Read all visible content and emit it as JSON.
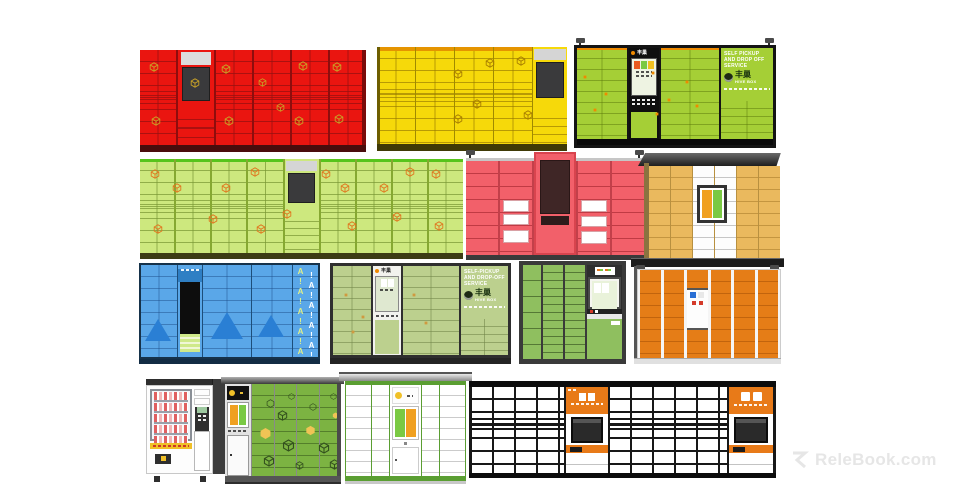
{
  "watermark": {
    "brand": "ReleBook.com"
  },
  "brands": {
    "hivebox_cn": "丰巢",
    "hivebox_en": "HIVE BOX"
  },
  "green_hivebox": {
    "console_logo": "丰巢",
    "panel_text": "SELF PICKUP AND DROP OFF SERVICE"
  },
  "sage_hivebox": {
    "console_logo": "丰巢",
    "panel_text": "SELF-PICKUP AND DROP-OFF SERVICE"
  },
  "blue_locker": {
    "pattern": "A!A!A!A!A!",
    "pattern2": "!A!A!A!A!"
  },
  "scene": {
    "background": "#ffffff",
    "units": [
      {
        "key": "red",
        "label": "Red smart parcel locker, 6 columns",
        "color": "#ea1510"
      },
      {
        "key": "yellow",
        "label": "Yellow smart parcel locker, 5 columns",
        "color": "#f6d90a"
      },
      {
        "key": "green-hivebox",
        "label": "Hive Box green parcel locker with console and cameras",
        "color": "#a5cf36"
      },
      {
        "key": "light-green",
        "label": "Light green parcel locker, 9 columns",
        "color": "#cde87e"
      },
      {
        "key": "pink",
        "label": "Pink parcel locker with raised center console and corner cameras",
        "color": "#f2606a"
      },
      {
        "key": "tan",
        "label": "Tan parcel locker with dark canopy",
        "color": "#eab95e"
      },
      {
        "key": "blue",
        "label": "Blue parcel locker with triangle logo pattern",
        "color": "#5aa7e8"
      },
      {
        "key": "sage-hivebox",
        "label": "Hive Box sage green parcel locker",
        "color": "#bcd08e"
      },
      {
        "key": "small-green",
        "label": "Compact green parcel locker with side console",
        "color": "#8fbf5f"
      },
      {
        "key": "orange",
        "label": "Orange parcel locker with canopy cameras",
        "color": "#e57d17"
      },
      {
        "key": "vending",
        "label": "Snack vending machine",
        "color": "#3a3a3a"
      },
      {
        "key": "dark-green",
        "label": "Green parcel locker with left console column",
        "color": "#7cb342"
      },
      {
        "key": "white-green",
        "label": "White and green parcel locker with center console",
        "color": "#5a9e32"
      },
      {
        "key": "long-white",
        "label": "Long white mailbox locker wall with two orange consoles",
        "color": "#ffffff"
      }
    ]
  },
  "icon_scatter": {
    "red": [
      {
        "x": 4,
        "y": 13
      },
      {
        "x": 36,
        "y": 15
      },
      {
        "x": 22,
        "y": 29
      },
      {
        "x": 52,
        "y": 29,
        "s": 9
      },
      {
        "x": 70,
        "y": 12
      },
      {
        "x": 85,
        "y": 13
      },
      {
        "x": 60,
        "y": 56,
        "s": 9
      },
      {
        "x": 5,
        "y": 69
      },
      {
        "x": 37,
        "y": 69
      },
      {
        "x": 68,
        "y": 69
      },
      {
        "x": 86,
        "y": 67
      }
    ],
    "yellow": [
      {
        "x": 57,
        "y": 11
      },
      {
        "x": 73,
        "y": 9
      },
      {
        "x": 40,
        "y": 23
      },
      {
        "x": 50,
        "y": 54
      },
      {
        "x": 40,
        "y": 69
      },
      {
        "x": 77,
        "y": 65
      }
    ],
    "lgreen": [
      {
        "x": 3,
        "y": 11
      },
      {
        "x": 10,
        "y": 25
      },
      {
        "x": 25,
        "y": 25
      },
      {
        "x": 21,
        "y": 58
      },
      {
        "x": 4,
        "y": 69
      },
      {
        "x": 34,
        "y": 9
      },
      {
        "x": 44,
        "y": 53
      },
      {
        "x": 36,
        "y": 69
      },
      {
        "x": 56,
        "y": 11
      },
      {
        "x": 62,
        "y": 25
      },
      {
        "x": 64,
        "y": 66
      },
      {
        "x": 74,
        "y": 25
      },
      {
        "x": 82,
        "y": 9
      },
      {
        "x": 90,
        "y": 11
      },
      {
        "x": 91,
        "y": 66
      },
      {
        "x": 78,
        "y": 56
      }
    ],
    "ghive": [
      {
        "x": 3,
        "y": 30,
        "t": "sq",
        "s": 4
      },
      {
        "x": 14,
        "y": 48,
        "t": "sq",
        "s": 4
      },
      {
        "x": 8,
        "y": 66,
        "t": "sq",
        "s": 4
      },
      {
        "x": 38,
        "y": 25,
        "t": "sq",
        "s": 4
      },
      {
        "x": 46,
        "y": 55,
        "t": "sq",
        "s": 4
      },
      {
        "x": 40,
        "y": 70,
        "t": "sq",
        "s": 4
      },
      {
        "x": 55,
        "y": 35,
        "t": "sq",
        "s": 4
      },
      {
        "x": 60,
        "y": 62,
        "t": "sq",
        "s": 4
      }
    ],
    "sage": [
      {
        "x": 6,
        "y": 30,
        "t": "sq",
        "s": 4
      },
      {
        "x": 16,
        "y": 55,
        "t": "sq",
        "s": 4
      },
      {
        "x": 45,
        "y": 30,
        "t": "sq",
        "s": 4
      },
      {
        "x": 52,
        "y": 62,
        "t": "sq",
        "s": 4
      },
      {
        "x": 10,
        "y": 72,
        "t": "sq",
        "s": 4
      }
    ],
    "dgreen": [
      {
        "x": 16,
        "y": 16,
        "t": "hexo",
        "s": 9
      },
      {
        "x": 40,
        "y": 10,
        "t": "hexo",
        "s": 7
      },
      {
        "x": 28,
        "y": 28,
        "t": "cube",
        "s": 11
      },
      {
        "x": 64,
        "y": 20,
        "t": "hexo",
        "s": 8
      },
      {
        "x": 88,
        "y": 10,
        "t": "hexo",
        "s": 7
      },
      {
        "x": 8,
        "y": 46,
        "t": "hex",
        "s": 13,
        "c": "#f0c455"
      },
      {
        "x": 60,
        "y": 44,
        "t": "hex",
        "s": 11,
        "c": "#f0c455"
      },
      {
        "x": 90,
        "y": 30,
        "t": "hex",
        "s": 7,
        "c": "#f0c455"
      },
      {
        "x": 34,
        "y": 58,
        "t": "cube",
        "s": 13
      },
      {
        "x": 74,
        "y": 62,
        "t": "cube",
        "s": 12
      },
      {
        "x": 12,
        "y": 76,
        "t": "cube",
        "s": 12
      },
      {
        "x": 48,
        "y": 82,
        "t": "cube",
        "s": 9
      },
      {
        "x": 86,
        "y": 80,
        "t": "cube",
        "s": 11
      }
    ]
  }
}
